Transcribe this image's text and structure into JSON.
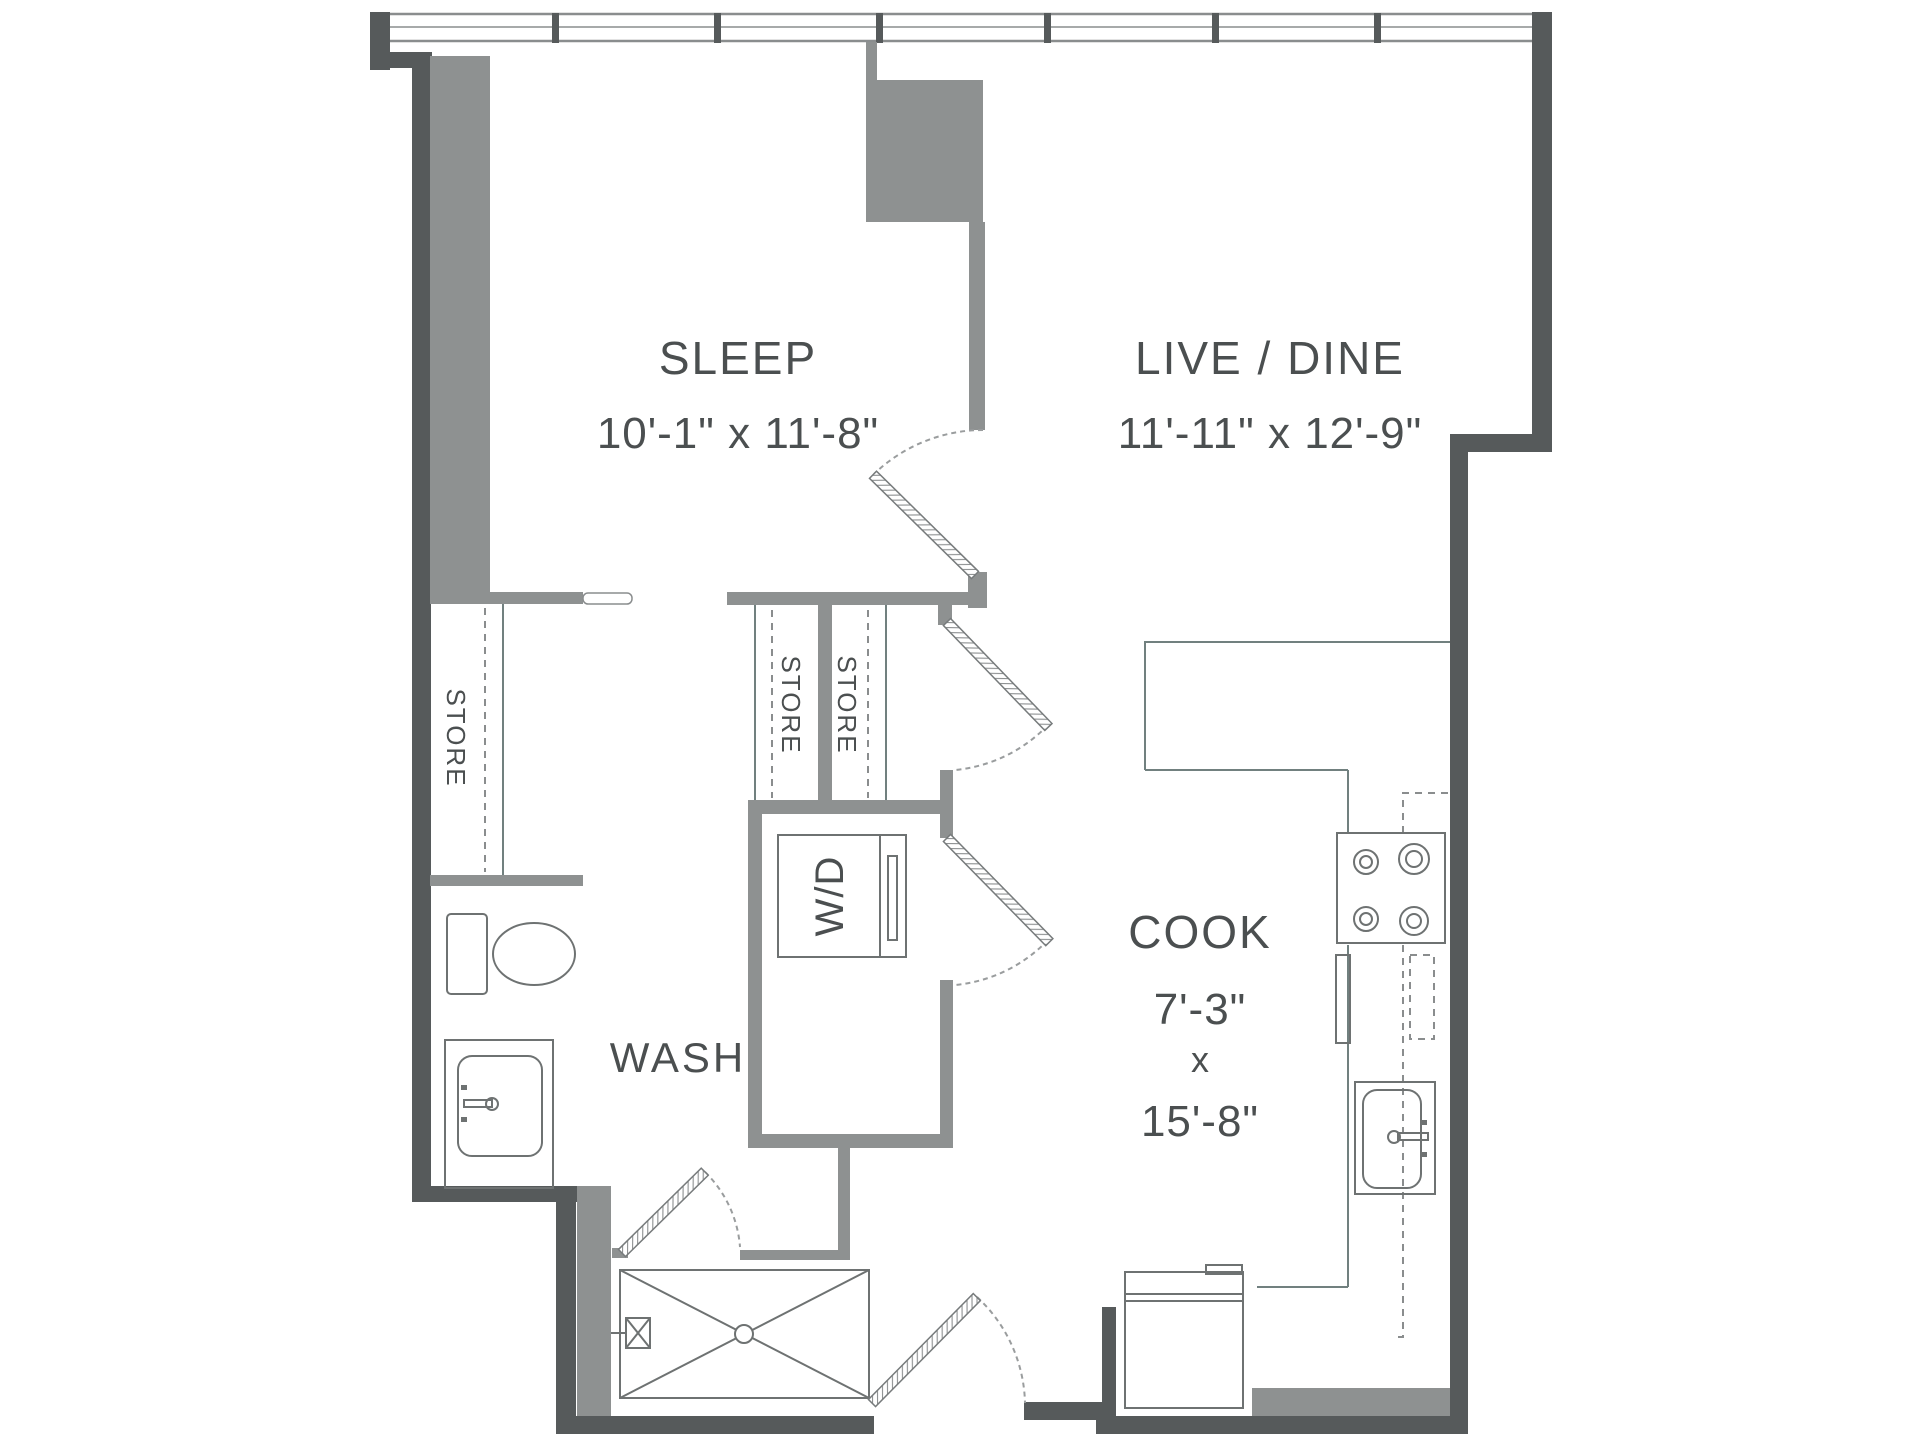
{
  "rooms": {
    "sleep": {
      "label": "SLEEP",
      "dims": "10'-1\" x 11'-8\""
    },
    "live_dine": {
      "label": "LIVE / DINE",
      "dims": "11'-11\" x 12'-9\""
    },
    "cook": {
      "label": "COOK",
      "width": "7'-3\"",
      "sep": "x",
      "length": "15'-8\""
    },
    "wash": {
      "label": "WASH"
    }
  },
  "labels": {
    "store": "STORE",
    "washer_dryer": "W/D"
  },
  "colors": {
    "wall_dark": "#565a5b",
    "wall_light": "#8e9191",
    "fixture_line": "#6e7272",
    "text": "#4b4f50",
    "background": "#ffffff"
  }
}
